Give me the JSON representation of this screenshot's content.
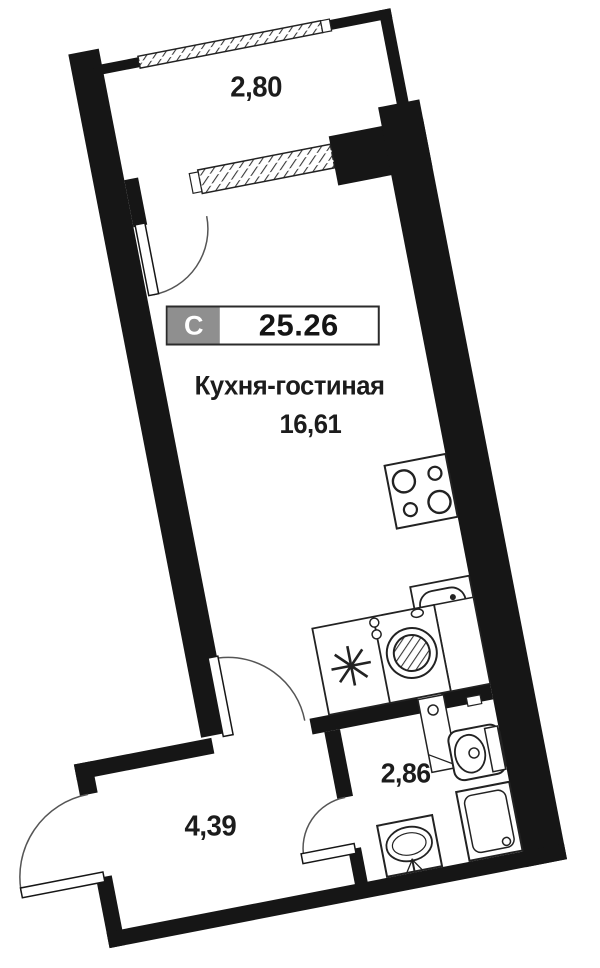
{
  "plan": {
    "title": "Studio apartment floor plan",
    "unit_badge": {
      "type_letter": "С",
      "total_area": "25.26"
    },
    "living_room": {
      "name": "Кухня-гостиная",
      "area": "16,61"
    },
    "balcony": {
      "width_label": "2,80"
    },
    "hallway": {
      "area": "4,39"
    },
    "bathroom": {
      "area": "2,86"
    },
    "fixtures": [
      "cooktop",
      "kitchen-sink",
      "refrigerator",
      "washing-machine",
      "plumbing-shaft",
      "toilet",
      "shower-tray",
      "washbasin"
    ]
  },
  "colors": {
    "wall": "#161616",
    "thin_line": "#222222",
    "arc_line": "#555555",
    "badge_gray": "#8f8f8f",
    "background": "#ffffff",
    "text": "#1c1c1c"
  }
}
